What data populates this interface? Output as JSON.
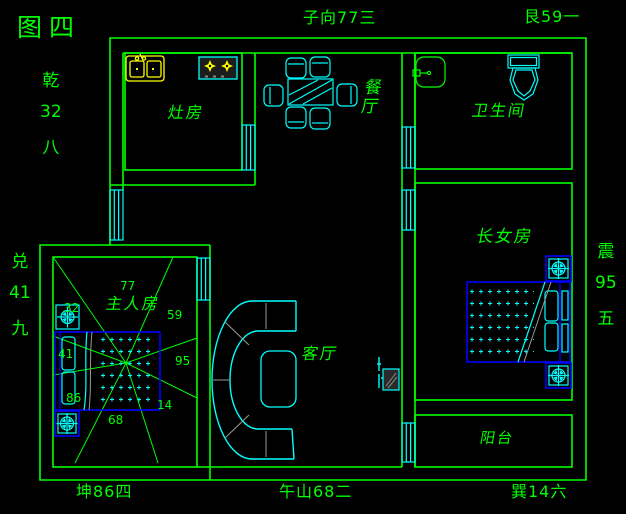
{
  "figure": {
    "title": "图四"
  },
  "compass": {
    "top": "子向77三",
    "top_right": "艮59一",
    "left_upper": [
      "乾",
      "32",
      "八"
    ],
    "left_lower": [
      "兑",
      "41",
      "九"
    ],
    "right": [
      "震",
      "95",
      "五"
    ],
    "bottom_left": "坤86四",
    "bottom_center": "午山68二",
    "bottom_right": "巽14六"
  },
  "rooms": {
    "kitchen": "灶房",
    "dining": "餐厅",
    "bathroom": "卫生间",
    "eldest_daughter": "长女房",
    "master": "主人房",
    "living": "客厅",
    "balcony": "阳台"
  },
  "master_stars": {
    "nw": "32",
    "n": "77",
    "ne": "59",
    "e": "95",
    "se": "14",
    "s": "68",
    "sw": "86",
    "w": "41"
  },
  "colors": {
    "background": "#000000",
    "wall_green": "#00ff00",
    "furniture_cyan": "#00ffff",
    "fixture_yellow": "#ffff00",
    "bed_frame_blue": "#0000ff",
    "detail_gray": "#999999"
  }
}
